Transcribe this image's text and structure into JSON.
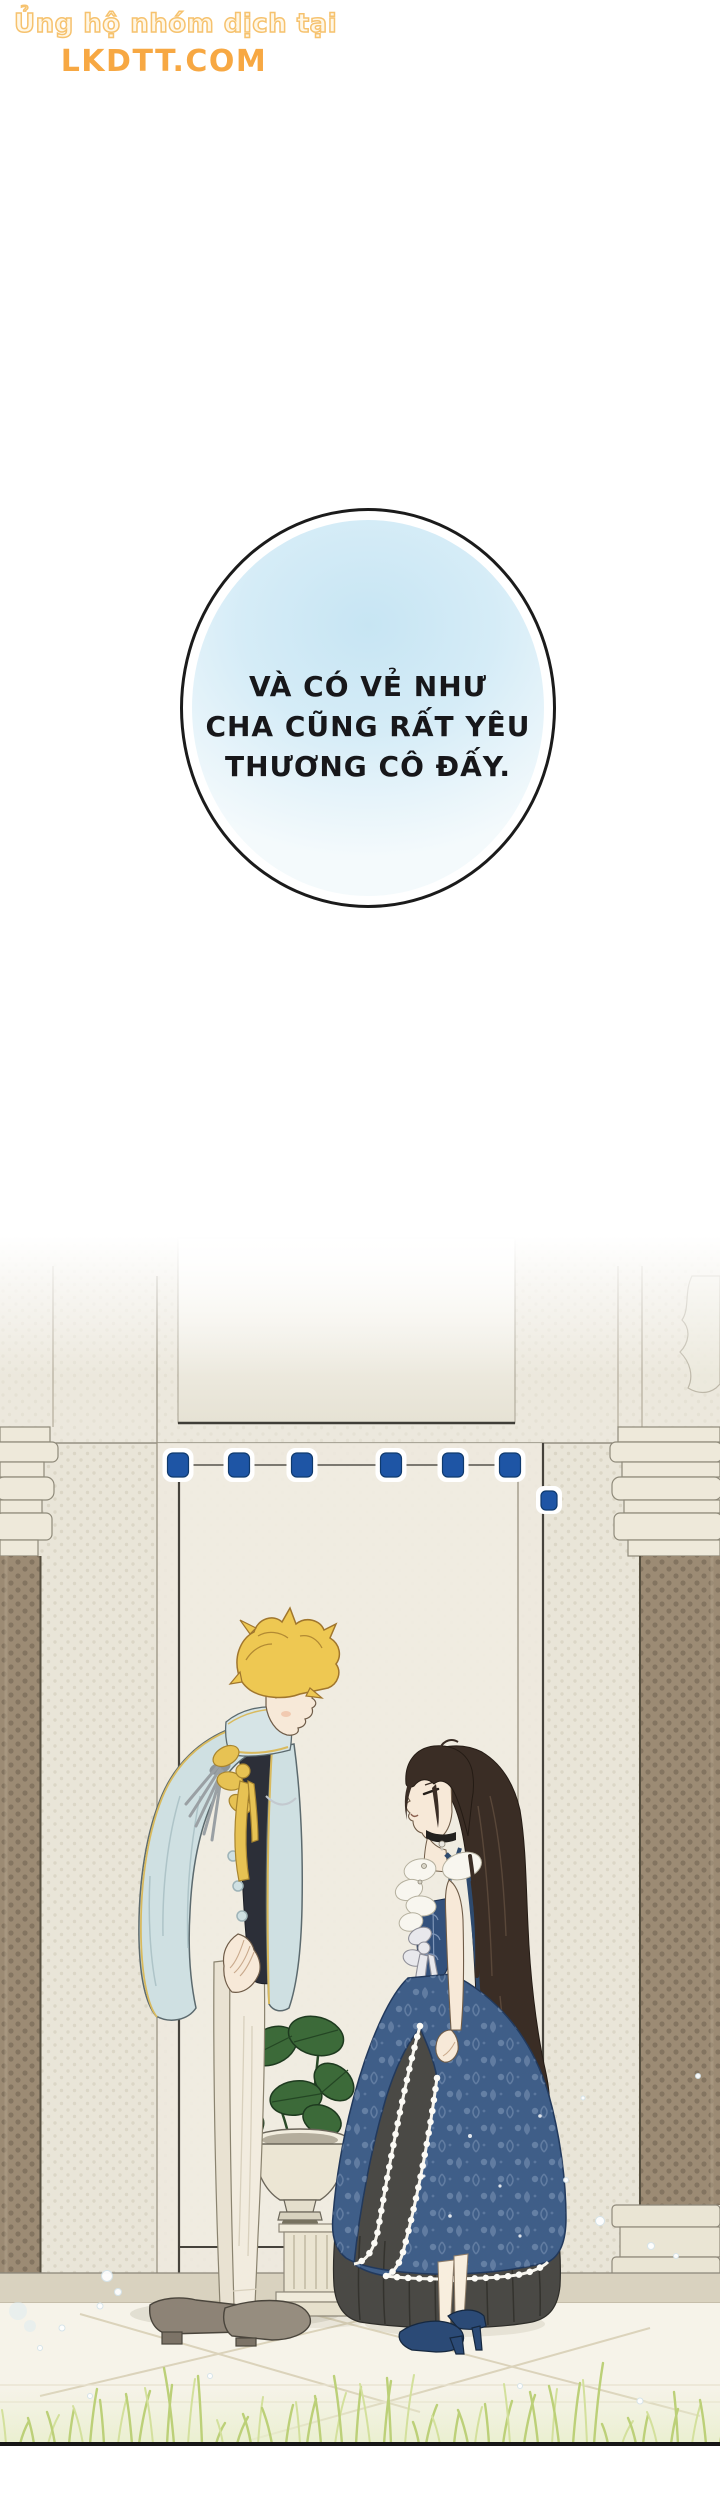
{
  "watermark": {
    "line1": "Ủng hộ nhóm dịch tại",
    "line2": "LKDTT.COM"
  },
  "bubble": {
    "lines": [
      "VÀ CÓ VẺ NHƯ",
      "CHA CŨNG RẤT YÊU",
      "THƯƠNG CÔ ĐẤY."
    ]
  },
  "palette": {
    "watermark_outline": "#f6c26e",
    "watermark_solid": "#f7a843",
    "bubble_outline": "#1b1b1b",
    "bubble_fill_top": "#c7e5f3",
    "ink": "#17171a",
    "wall": "#e9e5d8",
    "wall_dot": "#d0c9b7",
    "door": "#eeeadf",
    "line_dark": "#45423b",
    "line_light": "#9a9382",
    "gem_blue": "#1e55a5",
    "column_shaft": "#9c8b74",
    "column_stone": "#eae5d6",
    "step": "#d9d2bf",
    "floor": "#f6f3e9",
    "grass_green": "#bcd078",
    "skin": "#f7e9d8",
    "man_hair": "#eec852",
    "man_coat": "#cfe0e2",
    "man_coat_trim": "#d9ba5e",
    "man_shirt": "#2c2f38",
    "man_trousers": "#f2ecdf",
    "man_shoes": "#8d8376",
    "woman_hair": "#3a2d25",
    "dress_blue": "#3f5e88",
    "dress_pattern": "#93a9c6",
    "dress_lace": "#f7f5ee",
    "underskirt": "#4a4945",
    "woman_shoes": "#2b4a76",
    "plant_green": "#3c6a39"
  }
}
